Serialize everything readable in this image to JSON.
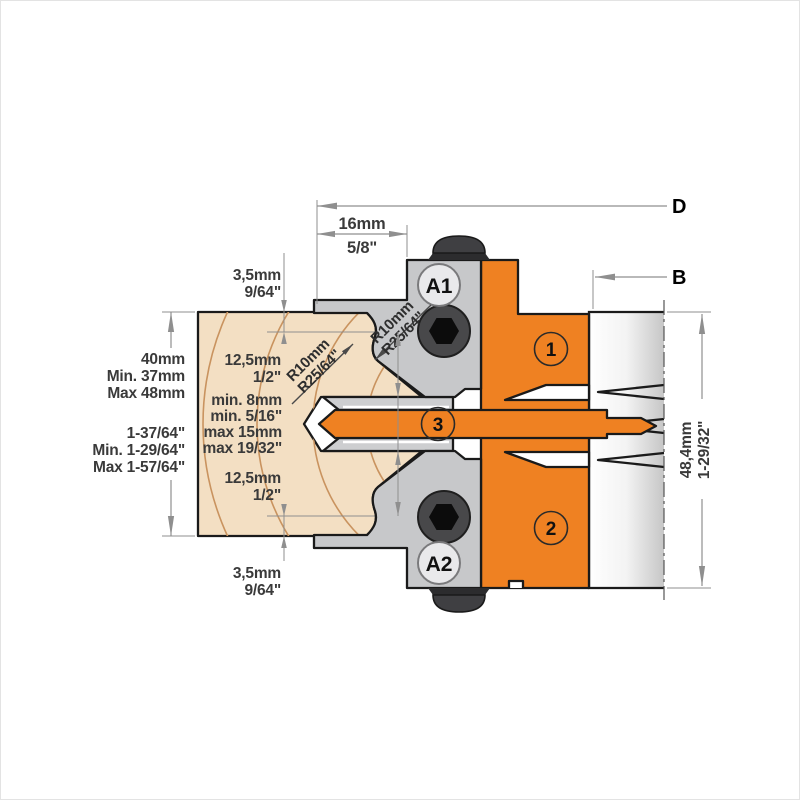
{
  "diagram": {
    "title": "profile-cutter-head-cross-section",
    "labels": {
      "d": "D",
      "b": "B",
      "a1": "A1",
      "a2": "A2",
      "knife1": "1",
      "knife2": "2",
      "knife3": "3"
    },
    "dims": {
      "width16": [
        "16mm",
        "5/8\""
      ],
      "gap_top": [
        "3,5mm",
        "9/64\""
      ],
      "gap_bottom": [
        "3,5mm",
        "9/64\""
      ],
      "height_left_mm": [
        "40mm",
        "Min. 37mm",
        "Max 48mm"
      ],
      "height_left_in": [
        "1-37/64\"",
        "Min. 1-29/64\"",
        "Max 1-57/64\""
      ],
      "profile_top": [
        "12,5mm",
        "1/2\""
      ],
      "groove": [
        "min. 8mm",
        "min. 5/16\"",
        "max 15mm",
        "max 19/32\""
      ],
      "profile_bottom": [
        "12,5mm",
        "1/2\""
      ],
      "body_height": [
        "48,4mm",
        "1-29/32\""
      ],
      "radius_upper": [
        "R10mm",
        "R25/64\""
      ],
      "radius_lower": [
        "R10mm",
        "R25/64\""
      ]
    },
    "colors": {
      "accent_orange": "#ef8122",
      "steel_gray": "#c7c8ca",
      "clamp_gray": "#cdced0",
      "wood_fill": "#f3dfc3",
      "wood_ring": "#c9935f",
      "outline": "#1a1a1a",
      "dimension_gray": "#8f8f8f",
      "screw_dark": "#454547"
    }
  }
}
